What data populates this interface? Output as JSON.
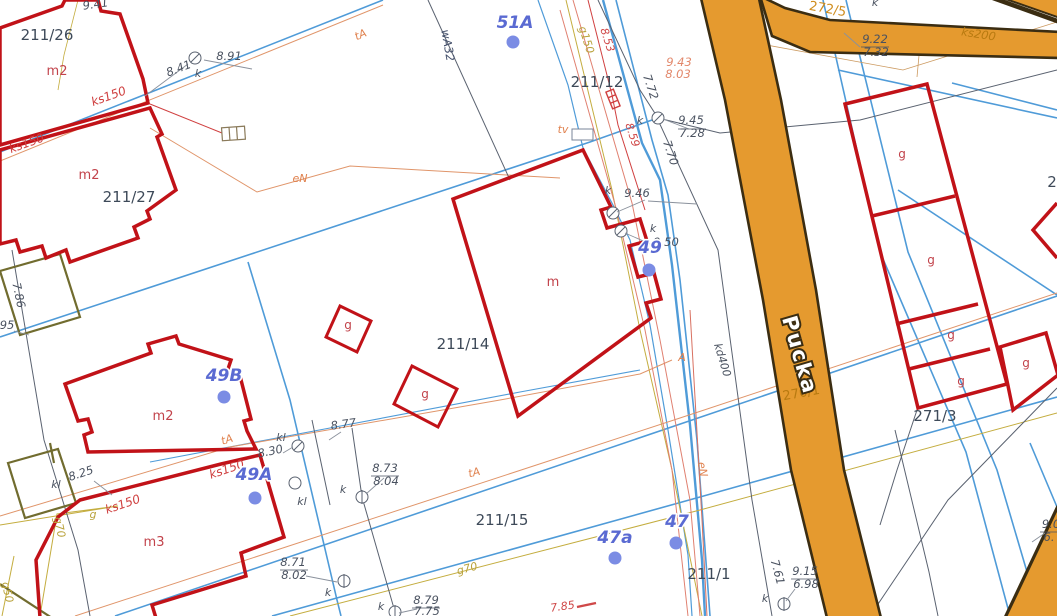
{
  "map": {
    "kind": "cadastral-base-map",
    "street_name": "Pucka",
    "colors": {
      "road_fill": "#e59a2f",
      "road_edge": "#3b2d12",
      "building_stroke": "#c11218",
      "other_building_stroke": "#716c2f",
      "water_line": "#4f9bd8",
      "gas_line": "#c4ad3f",
      "power_telecom_line": "#e0956a",
      "sewer_line": "#e08070",
      "boundary_line": "#5a6270",
      "address_color": "#5a6ad2",
      "parcel_color": "#3e4a59"
    }
  },
  "labels": [
    {
      "id": "parcel-211-26",
      "text": "211/26",
      "x": 47,
      "y": 40,
      "rot": 0,
      "cls": "parcel"
    },
    {
      "id": "parcel-211-27",
      "text": "211/27",
      "x": 129,
      "y": 202,
      "rot": 0,
      "cls": "parcel"
    },
    {
      "id": "parcel-211-12",
      "text": "211/12",
      "x": 597,
      "y": 87,
      "rot": 0,
      "cls": "parcel"
    },
    {
      "id": "parcel-211-14",
      "text": "211/14",
      "x": 463,
      "y": 349,
      "rot": 0,
      "cls": "parcel"
    },
    {
      "id": "parcel-211-15",
      "text": "211/15",
      "x": 502,
      "y": 525,
      "rot": 0,
      "cls": "parcel"
    },
    {
      "id": "parcel-211-1",
      "text": "211/1",
      "x": 709,
      "y": 579,
      "rot": 0,
      "cls": "parcel"
    },
    {
      "id": "parcel-271-3",
      "text": "271/3",
      "x": 935,
      "y": 421,
      "rot": 0,
      "cls": "parcel"
    },
    {
      "id": "parcel-272-5",
      "text": "272/5",
      "x": 827,
      "y": 13,
      "rot": 10,
      "cls": "parcel-or"
    },
    {
      "id": "parcel-270-1",
      "text": "270/1",
      "x": 802,
      "y": 397,
      "rot": -10,
      "cls": "parcel-road"
    },
    {
      "id": "parcel-partial",
      "text": "2",
      "x": 1052,
      "y": 187,
      "rot": 0,
      "cls": "parcel"
    },
    {
      "id": "bldg-m2-1",
      "text": "m2",
      "x": 57,
      "y": 75,
      "rot": 0,
      "cls": "bldg"
    },
    {
      "id": "bldg-m2-2",
      "text": "m2",
      "x": 89,
      "y": 179,
      "rot": 0,
      "cls": "bldg"
    },
    {
      "id": "bldg-m2-3",
      "text": "m2",
      "x": 163,
      "y": 420,
      "rot": 0,
      "cls": "bldg"
    },
    {
      "id": "bldg-m3",
      "text": "m3",
      "x": 154,
      "y": 546,
      "rot": 0,
      "cls": "bldg"
    },
    {
      "id": "bldg-m",
      "text": "m",
      "x": 553,
      "y": 286,
      "rot": 0,
      "cls": "bldg"
    },
    {
      "id": "bldg-g-1",
      "text": "g",
      "x": 348,
      "y": 329,
      "rot": 0,
      "cls": "bldg-sm"
    },
    {
      "id": "bldg-g-2",
      "text": "g",
      "x": 425,
      "y": 398,
      "rot": 0,
      "cls": "bldg-sm"
    },
    {
      "id": "bldg-g-3",
      "text": "g",
      "x": 902,
      "y": 158,
      "rot": 0,
      "cls": "bldg-sm"
    },
    {
      "id": "bldg-g-4",
      "text": "g",
      "x": 931,
      "y": 264,
      "rot": 0,
      "cls": "bldg-sm"
    },
    {
      "id": "bldg-g-5",
      "text": "g",
      "x": 951,
      "y": 339,
      "rot": 0,
      "cls": "bldg-sm"
    },
    {
      "id": "bldg-g-6",
      "text": "g",
      "x": 961,
      "y": 385,
      "rot": 0,
      "cls": "bldg-sm"
    },
    {
      "id": "bldg-g-7",
      "text": "g",
      "x": 1026,
      "y": 367,
      "rot": 0,
      "cls": "bldg-sm"
    },
    {
      "id": "street-name",
      "text": "Pucka",
      "x": 793,
      "y": 357,
      "rot": 74,
      "cls": "street"
    },
    {
      "id": "util-ks150-1",
      "text": "ks150",
      "x": 110,
      "y": 100,
      "rot": -20,
      "cls": "ured"
    },
    {
      "id": "util-ks150-2",
      "text": "ks150",
      "x": 28,
      "y": 147,
      "rot": -20,
      "cls": "ured"
    },
    {
      "id": "util-ks150-3",
      "text": "ks150",
      "x": 228,
      "y": 473,
      "rot": -19,
      "cls": "ured"
    },
    {
      "id": "util-ks150-4",
      "text": "ks150",
      "x": 124,
      "y": 508,
      "rot": -19,
      "cls": "ured"
    },
    {
      "id": "util-ks200",
      "text": "ks200",
      "x": 978,
      "y": 38,
      "rot": 9,
      "cls": "uroad"
    },
    {
      "id": "util-kd400",
      "text": "kd400",
      "x": 719,
      "y": 361,
      "rot": 73,
      "cls": "udark"
    },
    {
      "id": "util-wA32",
      "text": "wA32",
      "x": 444,
      "y": 46,
      "rot": 80,
      "cls": "ublue"
    },
    {
      "id": "util-g150",
      "text": "g150",
      "x": 583,
      "y": 41,
      "rot": 72,
      "cls": "uyel"
    },
    {
      "id": "util-g70-1",
      "text": "g70",
      "x": 56,
      "y": 528,
      "rot": 78,
      "cls": "uyel"
    },
    {
      "id": "util-g70-2",
      "text": "g70",
      "x": 468,
      "y": 572,
      "rot": -15,
      "cls": "uyel"
    },
    {
      "id": "util-g",
      "text": "g",
      "x": 93,
      "y": 518,
      "rot": 0,
      "cls": "uyel"
    },
    {
      "id": "util-g50",
      "text": "g50",
      "x": 4,
      "y": 593,
      "rot": 78,
      "cls": "uyel"
    },
    {
      "id": "util-tA-1",
      "text": "tA",
      "x": 362,
      "y": 38,
      "rot": -23,
      "cls": "uor"
    },
    {
      "id": "util-tA-2",
      "text": "tA",
      "x": 228,
      "y": 443,
      "rot": -17,
      "cls": "uor"
    },
    {
      "id": "util-tA-3",
      "text": "tA",
      "x": 475,
      "y": 476,
      "rot": -14,
      "cls": "uor"
    },
    {
      "id": "util-tv",
      "text": "tv",
      "x": 563,
      "y": 133,
      "rot": 0,
      "cls": "uor"
    },
    {
      "id": "util-eN-1",
      "text": "eN",
      "x": 300,
      "y": 182,
      "rot": 0,
      "cls": "uor"
    },
    {
      "id": "util-eN-2",
      "text": "eN",
      "x": 699,
      "y": 470,
      "rot": 80,
      "cls": "uor"
    },
    {
      "id": "util-A",
      "text": "A",
      "x": 682,
      "y": 361,
      "rot": 0,
      "cls": "uor"
    },
    {
      "id": "util-k-1",
      "text": "k",
      "x": 198,
      "y": 77,
      "rot": 0,
      "cls": "udark"
    },
    {
      "id": "util-k-2",
      "text": "k",
      "x": 640,
      "y": 124,
      "rot": 0,
      "cls": "udark"
    },
    {
      "id": "util-k-3",
      "text": "k",
      "x": 608,
      "y": 194,
      "rot": 0,
      "cls": "udark"
    },
    {
      "id": "util-k-4",
      "text": "k",
      "x": 653,
      "y": 232,
      "rot": 0,
      "cls": "udark"
    },
    {
      "id": "util-k-5",
      "text": "k",
      "x": 875,
      "y": 6,
      "rot": 0,
      "cls": "udark"
    },
    {
      "id": "util-k-6",
      "text": "k",
      "x": 765,
      "y": 602,
      "rot": 0,
      "cls": "udark"
    },
    {
      "id": "util-k-7",
      "text": "k",
      "x": 343,
      "y": 493,
      "rot": 0,
      "cls": "udark"
    },
    {
      "id": "util-k-8",
      "text": "k",
      "x": 381,
      "y": 610,
      "rot": 0,
      "cls": "udark"
    },
    {
      "id": "util-k-9",
      "text": "k",
      "x": 328,
      "y": 596,
      "rot": 0,
      "cls": "udark"
    },
    {
      "id": "util-kl-1",
      "text": "kl",
      "x": 281,
      "y": 441,
      "rot": 0,
      "cls": "udark"
    },
    {
      "id": "util-kl-2",
      "text": "kl",
      "x": 302,
      "y": 505,
      "rot": 0,
      "cls": "udark"
    },
    {
      "id": "util-kl-3",
      "text": "kl",
      "x": 56,
      "y": 488,
      "rot": 0,
      "cls": "udark"
    },
    {
      "id": "elev-941",
      "text": "9.41",
      "x": 96,
      "y": 8,
      "rot": -8,
      "cls": "elev"
    },
    {
      "id": "elev-841",
      "text": "8.41",
      "x": 180,
      "y": 72,
      "rot": -21,
      "cls": "elev"
    },
    {
      "id": "elev-891",
      "text": "8.91",
      "x": 229,
      "y": 60,
      "rot": 0,
      "cls": "elev"
    },
    {
      "id": "elev-772",
      "text": "7.72",
      "x": 647,
      "y": 88,
      "rot": 72,
      "cls": "elev"
    },
    {
      "id": "elev-770",
      "text": "7.70",
      "x": 667,
      "y": 154,
      "rot": 72,
      "cls": "elev"
    },
    {
      "id": "elev-946",
      "text": "9.46",
      "x": 637,
      "y": 197,
      "rot": 0,
      "cls": "elev"
    },
    {
      "id": "elev-950",
      "text": "9.50",
      "x": 666,
      "y": 246,
      "rot": 0,
      "cls": "elev"
    },
    {
      "id": "elev-945",
      "text": "9.45",
      "x": 691,
      "y": 124,
      "rot": 0,
      "cls": "elev"
    },
    {
      "id": "elev-728",
      "text": "7.28",
      "x": 692,
      "y": 137,
      "rot": 0,
      "cls": "elev"
    },
    {
      "id": "elev-943",
      "text": "9.43",
      "x": 679,
      "y": 66,
      "rot": 0,
      "cls": "elev-sal"
    },
    {
      "id": "elev-803",
      "text": "8.03",
      "x": 678,
      "y": 78,
      "rot": 0,
      "cls": "elev-sal"
    },
    {
      "id": "elev-922",
      "text": "9.22",
      "x": 875,
      "y": 43,
      "rot": 0,
      "cls": "elev"
    },
    {
      "id": "elev-732",
      "text": "7.32",
      "x": 876,
      "y": 56,
      "rot": 0,
      "cls": "elev"
    },
    {
      "id": "elev-786",
      "text": "7.86",
      "x": 15,
      "y": 296,
      "rot": 78,
      "cls": "elev"
    },
    {
      "id": "elev-95",
      "text": "95",
      "x": 7,
      "y": 329,
      "rot": 0,
      "cls": "elev"
    },
    {
      "id": "elev-877",
      "text": "8.77",
      "x": 344,
      "y": 428,
      "rot": -8,
      "cls": "elev"
    },
    {
      "id": "elev-830",
      "text": "8.30",
      "x": 271,
      "y": 455,
      "rot": -12,
      "cls": "elev"
    },
    {
      "id": "elev-825",
      "text": "8.25",
      "x": 82,
      "y": 477,
      "rot": -18,
      "cls": "elev"
    },
    {
      "id": "elev-873",
      "text": "8.73",
      "x": 385,
      "y": 472,
      "rot": 0,
      "cls": "elev"
    },
    {
      "id": "elev-804",
      "text": "8.04",
      "x": 386,
      "y": 485,
      "rot": 0,
      "cls": "elev"
    },
    {
      "id": "elev-871",
      "text": "8.71",
      "x": 293,
      "y": 566,
      "rot": 0,
      "cls": "elev"
    },
    {
      "id": "elev-802",
      "text": "8.02",
      "x": 294,
      "y": 579,
      "rot": 0,
      "cls": "elev"
    },
    {
      "id": "elev-879",
      "text": "8.79",
      "x": 426,
      "y": 604,
      "rot": 0,
      "cls": "elev"
    },
    {
      "id": "elev-775",
      "text": "7.75",
      "x": 427,
      "y": 615,
      "rot": 0,
      "cls": "elev"
    },
    {
      "id": "elev-915",
      "text": "9.15",
      "x": 805,
      "y": 575,
      "rot": 0,
      "cls": "elev"
    },
    {
      "id": "elev-698",
      "text": "6.98",
      "x": 806,
      "y": 588,
      "rot": 0,
      "cls": "elev"
    },
    {
      "id": "elev-761",
      "text": "7.61",
      "x": 774,
      "y": 573,
      "rot": 75,
      "cls": "elev"
    },
    {
      "id": "elev-90",
      "text": "9.0",
      "x": 1051,
      "y": 528,
      "rot": 0,
      "cls": "elev"
    },
    {
      "id": "elev-6x",
      "text": "6.",
      "x": 1049,
      "y": 541,
      "rot": 0,
      "cls": "elev"
    },
    {
      "id": "elev-853",
      "text": "8.53",
      "x": 604,
      "y": 41,
      "rot": 72,
      "cls": "elev-red"
    },
    {
      "id": "elev-859",
      "text": "8.59",
      "x": 629,
      "y": 136,
      "rot": 72,
      "cls": "elev-red"
    },
    {
      "id": "elev-785",
      "text": "7.85",
      "x": 563,
      "y": 610,
      "rot": -8,
      "cls": "elev-red"
    },
    {
      "id": "addr-51A",
      "text": "51A",
      "x": 515,
      "y": 28,
      "rot": 0,
      "cls": "addr"
    },
    {
      "id": "addr-49",
      "text": "49",
      "x": 650,
      "y": 253,
      "rot": 0,
      "cls": "addr"
    },
    {
      "id": "addr-49B",
      "text": "49B",
      "x": 224,
      "y": 381,
      "rot": 0,
      "cls": "addr"
    },
    {
      "id": "addr-49A",
      "text": "49A",
      "x": 254,
      "y": 480,
      "rot": 0,
      "cls": "addr"
    },
    {
      "id": "addr-47a",
      "text": "47a",
      "x": 615,
      "y": 543,
      "rot": 0,
      "cls": "addr"
    },
    {
      "id": "addr-47",
      "text": "47",
      "x": 677,
      "y": 527,
      "rot": 0,
      "cls": "addr"
    }
  ],
  "address_points": [
    {
      "id": "addr-dot-51A",
      "x": 513,
      "y": 42
    },
    {
      "id": "addr-dot-49",
      "x": 649,
      "y": 270
    },
    {
      "id": "addr-dot-49B",
      "x": 224,
      "y": 397
    },
    {
      "id": "addr-dot-49A",
      "x": 255,
      "y": 498
    },
    {
      "id": "addr-dot-47a",
      "x": 615,
      "y": 558
    },
    {
      "id": "addr-dot-47",
      "x": 676,
      "y": 543
    }
  ]
}
